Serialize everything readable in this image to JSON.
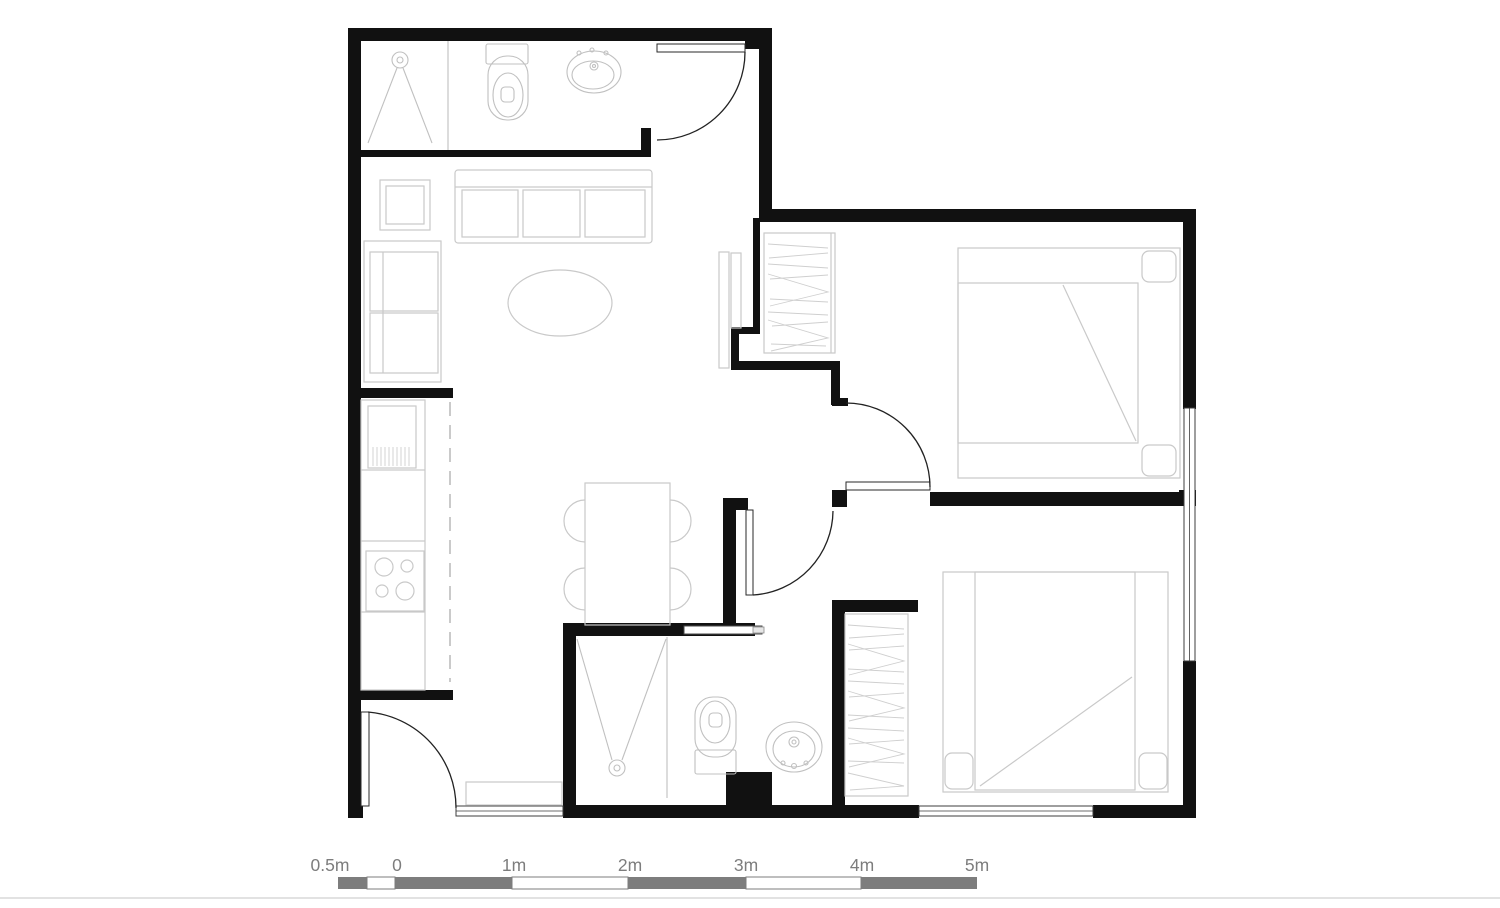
{
  "document": {
    "title": "Two-bedroom apartment floor plan",
    "kind": "architectural-floor-plan"
  },
  "colors": {
    "wall": "#111111",
    "arc": "#222222",
    "furniture": "#c9c9c9",
    "fixture": "#c0c0c0",
    "window": "#3c3c3c",
    "scale_gray": "#7d7d7d",
    "scale_text": "#7d7d7d",
    "baseline": "#d9d9d9",
    "background": "#ffffff"
  },
  "scale_bar": {
    "labels": [
      "0.5m",
      "0",
      "1m",
      "2m",
      "3m",
      "4m",
      "5m"
    ]
  },
  "plan": {
    "areas": [
      {
        "name": "bathroom-main",
        "symbols": [
          "shower",
          "toilet",
          "washbasin",
          "swing-door"
        ]
      },
      {
        "name": "living-room",
        "symbols": [
          "sofa",
          "side-table",
          "shelf-unit",
          "coffee-table",
          "tv-cabinet"
        ]
      },
      {
        "name": "kitchen",
        "symbols": [
          "counter",
          "kitchen-sink",
          "stove",
          "dashed-zone-line"
        ]
      },
      {
        "name": "dining-area",
        "symbols": [
          "dining-table",
          "four-chairs"
        ]
      },
      {
        "name": "entry",
        "symbols": [
          "entry-swing-door",
          "doormat",
          "window"
        ]
      },
      {
        "name": "hallway",
        "symbols": [
          "bedroom-1-swing-door",
          "bedroom-2-swing-door"
        ]
      },
      {
        "name": "bathroom-2",
        "symbols": [
          "shower",
          "toilet",
          "washbasin",
          "sliding-door"
        ]
      },
      {
        "name": "bedroom-1",
        "symbols": [
          "wardrobe",
          "double-bed",
          "pillows",
          "window"
        ]
      },
      {
        "name": "bedroom-2",
        "symbols": [
          "wardrobe",
          "double-bed",
          "pillows",
          "window"
        ]
      }
    ]
  }
}
